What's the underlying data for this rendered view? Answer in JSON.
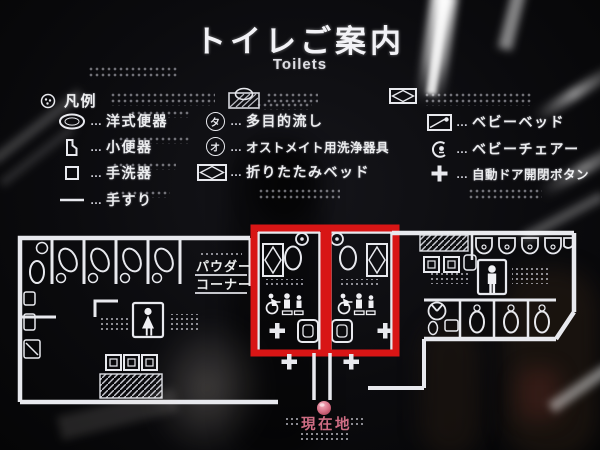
{
  "title": {
    "ja": "トイレご案内",
    "en": "Toilets"
  },
  "legend": {
    "header_label": "凡例",
    "leader": "…",
    "col1": [
      {
        "icon": "western-toilet-icon",
        "label": "洋式便器"
      },
      {
        "icon": "urinal-icon",
        "label": "小便器"
      },
      {
        "icon": "hand-basin-icon",
        "label": "手洗器"
      },
      {
        "icon": "handrail-icon",
        "label": "手すり"
      }
    ],
    "col2": [
      {
        "icon": "multipurpose-sink-icon",
        "glyph": "タ",
        "label": "多目的流し"
      },
      {
        "icon": "ostomate-icon",
        "glyph": "オ",
        "label": "オストメイト用洗浄器具"
      },
      {
        "icon": "folding-bed-icon",
        "label": "折りたたみベッド"
      }
    ],
    "col3": [
      {
        "icon": "baby-bed-icon",
        "label": "ベビーベッド"
      },
      {
        "icon": "baby-chair-icon",
        "label": "ベビーチェアー"
      },
      {
        "icon": "door-button-icon",
        "label": "自動ドア開閉ボタン"
      }
    ]
  },
  "map": {
    "powder_corner_line1": "パウダー",
    "powder_corner_line2": "コーナー",
    "current_location": "現在地",
    "highlighted_rooms": 2
  },
  "colors": {
    "highlight_red": "#d81515",
    "location_pink": "#cf6d84",
    "line_white": "#e8e9ee",
    "background": "#0b0b0e"
  }
}
